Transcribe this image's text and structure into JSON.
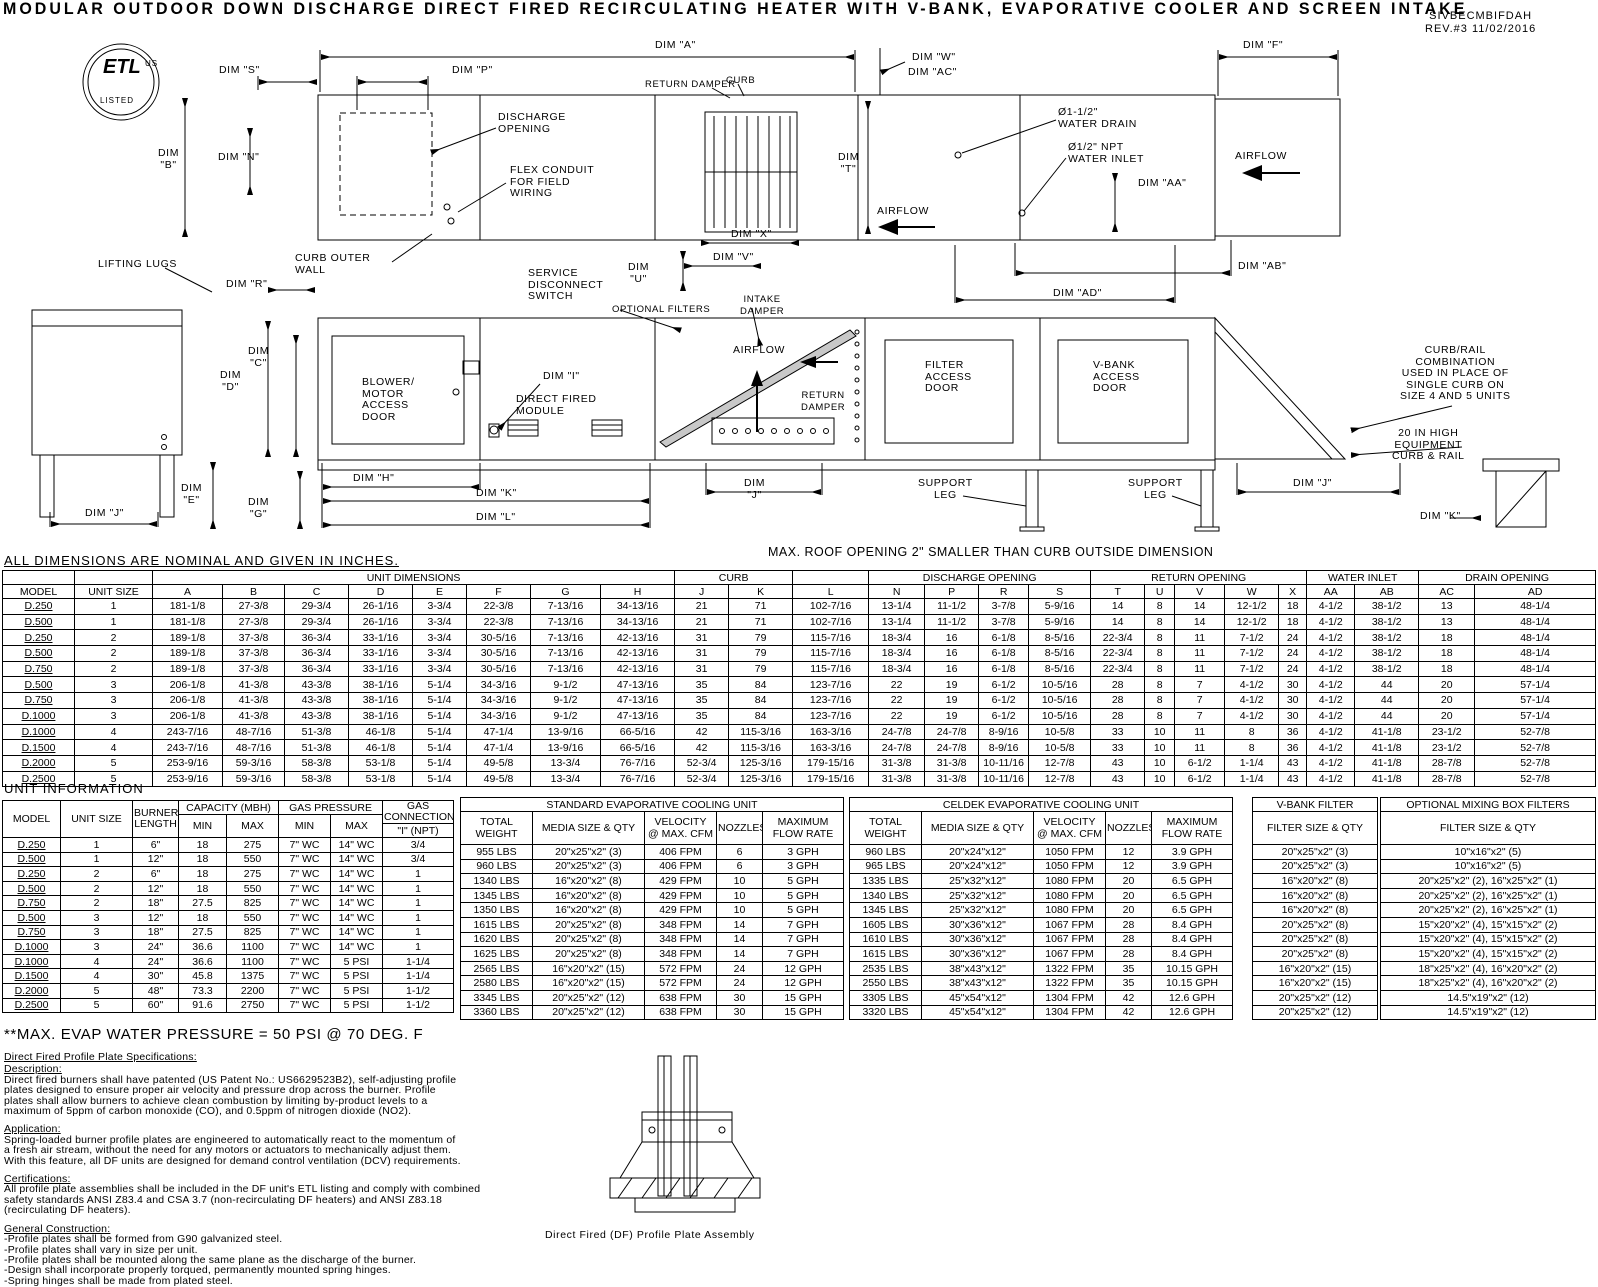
{
  "header": {
    "title": "MODULAR OUTDOOR DOWN DISCHARGE DIRECT FIRED RECIRCULATING HEATER WITH V-BANK, EVAPORATIVE COOLER AND SCREEN INTAKE",
    "doc_code": "SIVBECMBIFDAH\nREV.#3  11/02/2016"
  },
  "notes": {
    "dims_note": "ALL DIMENSIONS ARE NOMINAL AND GIVEN IN INCHES.",
    "roof_note": "MAX. ROOF OPENING 2\" SMALLER THAN CURB OUTSIDE DIMENSION",
    "evap_note": "**MAX. EVAP WATER PRESSURE = 50 PSI @ 70 DEG. F",
    "assembly_caption": "Direct Fired (DF) Profile Plate Assembly"
  },
  "drawing": {
    "labels": {
      "etl_mark": "ETL",
      "etl_listed": "LISTED",
      "etl_us": "US",
      "dim_s": "DIM \"S\"",
      "dim_p": "DIM \"P\"",
      "dim_a": "DIM \"A\"",
      "dim_f": "DIM \"F\"",
      "dim_w": "DIM \"W\"",
      "dim_ac": "DIM \"AC\"",
      "return_damper": "RETURN DAMPER",
      "curb": "CURB",
      "discharge_opening": "DISCHARGE\nOPENING",
      "water_drain": "Ø1-1/2\"\nWATER DRAIN",
      "water_inlet": "Ø1/2\" NPT\nWATER INLET",
      "airflow_top_right": "AIRFLOW",
      "dim_b": "DIM\n\"B\"",
      "dim_n": "DIM \"N\"",
      "dim_t": "DIM\n\"T\"",
      "flex_conduit": "FLEX CONDUIT\nFOR FIELD\nWIRING",
      "dim_aa": "DIM \"AA\"",
      "airflow_mid": "AIRFLOW",
      "dim_x": "DIM \"X\"",
      "dim_v": "DIM \"V\"",
      "dim_ab": "DIM \"AB\"",
      "lifting_lugs": "LIFTING LUGS",
      "curb_outer_wall": "CURB OUTER\nWALL",
      "service_disconnect": "SERVICE\nDISCONNECT\nSWITCH",
      "dim_u": "DIM\n\"U\"",
      "dim_r": "DIM \"R\"",
      "dim_ad": "DIM \"AD\"",
      "intake_damper": "INTAKE\nDAMPER",
      "optional_filters": "OPTIONAL FILTERS",
      "dim_c": "DIM\n\"C\"",
      "dim_d": "DIM\n\"D\"",
      "airflow_center": "AIRFLOW",
      "blower_door": "BLOWER/\nMOTOR\nACCESS\nDOOR",
      "dim_i": "DIM \"I\"",
      "direct_fired_module": "DIRECT FIRED\nMODULE",
      "return_damper_2": "RETURN\nDAMPER",
      "filter_access_door": "FILTER\nACCESS\nDOOR",
      "vbank_access_door": "V-BANK\nACCESS\nDOOR",
      "curb_rail_combo": "CURB/RAIL\nCOMBINATION\nUSED IN PLACE OF\nSINGLE CURB ON\nSIZE 4 AND 5 UNITS",
      "curb_20": "20 IN HIGH\nEQUIPMENT\nCURB & RAIL",
      "support_leg_1": "SUPPORT\nLEG",
      "support_leg_2": "SUPPORT\nLEG",
      "dim_e": "DIM\n\"E\"",
      "dim_g": "DIM\n\"G\"",
      "dim_h": "DIM \"H\"",
      "dim_k_bottom": "DIM \"K\"",
      "dim_l": "DIM \"L\"",
      "dim_j_mid": "DIM\n\"J\"",
      "dim_j_left": "DIM \"J\"",
      "dim_j_right": "DIM \"J\"",
      "dim_k_right": "DIM \"K\""
    }
  },
  "dimension_table": {
    "group_headers": {
      "unit_dimensions": "UNIT DIMENSIONS",
      "curb": "CURB",
      "discharge": "DISCHARGE OPENING",
      "return": "RETURN OPENING",
      "water_inlet": "WATER INLET",
      "drain": "DRAIN OPENING"
    },
    "columns": [
      "MODEL",
      "UNIT SIZE",
      "A",
      "B",
      "C",
      "D",
      "E",
      "F",
      "G",
      "H",
      "J",
      "K",
      "L",
      "N",
      "P",
      "R",
      "S",
      "T",
      "U",
      "V",
      "W",
      "X",
      "AA",
      "AB",
      "AC",
      "AD"
    ],
    "rows": [
      [
        "D.250",
        "1",
        "181-1/8",
        "27-3/8",
        "29-3/4",
        "26-1/16",
        "3-3/4",
        "22-3/8",
        "7-13/16",
        "34-13/16",
        "21",
        "71",
        "102-7/16",
        "13-1/4",
        "11-1/2",
        "3-7/8",
        "5-9/16",
        "14",
        "8",
        "14",
        "12-1/2",
        "18",
        "4-1/2",
        "38-1/2",
        "13",
        "48-1/4"
      ],
      [
        "D.500",
        "1",
        "181-1/8",
        "27-3/8",
        "29-3/4",
        "26-1/16",
        "3-3/4",
        "22-3/8",
        "7-13/16",
        "34-13/16",
        "21",
        "71",
        "102-7/16",
        "13-1/4",
        "11-1/2",
        "3-7/8",
        "5-9/16",
        "14",
        "8",
        "14",
        "12-1/2",
        "18",
        "4-1/2",
        "38-1/2",
        "13",
        "48-1/4"
      ],
      [
        "D.250",
        "2",
        "189-1/8",
        "37-3/8",
        "36-3/4",
        "33-1/16",
        "3-3/4",
        "30-5/16",
        "7-13/16",
        "42-13/16",
        "31",
        "79",
        "115-7/16",
        "18-3/4",
        "16",
        "6-1/8",
        "8-5/16",
        "22-3/4",
        "8",
        "11",
        "7-1/2",
        "24",
        "4-1/2",
        "38-1/2",
        "18",
        "48-1/4"
      ],
      [
        "D.500",
        "2",
        "189-1/8",
        "37-3/8",
        "36-3/4",
        "33-1/16",
        "3-3/4",
        "30-5/16",
        "7-13/16",
        "42-13/16",
        "31",
        "79",
        "115-7/16",
        "18-3/4",
        "16",
        "6-1/8",
        "8-5/16",
        "22-3/4",
        "8",
        "11",
        "7-1/2",
        "24",
        "4-1/2",
        "38-1/2",
        "18",
        "48-1/4"
      ],
      [
        "D.750",
        "2",
        "189-1/8",
        "37-3/8",
        "36-3/4",
        "33-1/16",
        "3-3/4",
        "30-5/16",
        "7-13/16",
        "42-13/16",
        "31",
        "79",
        "115-7/16",
        "18-3/4",
        "16",
        "6-1/8",
        "8-5/16",
        "22-3/4",
        "8",
        "11",
        "7-1/2",
        "24",
        "4-1/2",
        "38-1/2",
        "18",
        "48-1/4"
      ],
      [
        "D.500",
        "3",
        "206-1/8",
        "41-3/8",
        "43-3/8",
        "38-1/16",
        "5-1/4",
        "34-3/16",
        "9-1/2",
        "47-13/16",
        "35",
        "84",
        "123-7/16",
        "22",
        "19",
        "6-1/2",
        "10-5/16",
        "28",
        "8",
        "7",
        "4-1/2",
        "30",
        "4-1/2",
        "44",
        "20",
        "57-1/4"
      ],
      [
        "D.750",
        "3",
        "206-1/8",
        "41-3/8",
        "43-3/8",
        "38-1/16",
        "5-1/4",
        "34-3/16",
        "9-1/2",
        "47-13/16",
        "35",
        "84",
        "123-7/16",
        "22",
        "19",
        "6-1/2",
        "10-5/16",
        "28",
        "8",
        "7",
        "4-1/2",
        "30",
        "4-1/2",
        "44",
        "20",
        "57-1/4"
      ],
      [
        "D.1000",
        "3",
        "206-1/8",
        "41-3/8",
        "43-3/8",
        "38-1/16",
        "5-1/4",
        "34-3/16",
        "9-1/2",
        "47-13/16",
        "35",
        "84",
        "123-7/16",
        "22",
        "19",
        "6-1/2",
        "10-5/16",
        "28",
        "8",
        "7",
        "4-1/2",
        "30",
        "4-1/2",
        "44",
        "20",
        "57-1/4"
      ],
      [
        "D.1000",
        "4",
        "243-7/16",
        "48-7/16",
        "51-3/8",
        "46-1/8",
        "5-1/4",
        "47-1/4",
        "13-9/16",
        "66-5/16",
        "42",
        "115-3/16",
        "163-3/16",
        "24-7/8",
        "24-7/8",
        "8-9/16",
        "10-5/8",
        "33",
        "10",
        "11",
        "8",
        "36",
        "4-1/2",
        "41-1/8",
        "23-1/2",
        "52-7/8"
      ],
      [
        "D.1500",
        "4",
        "243-7/16",
        "48-7/16",
        "51-3/8",
        "46-1/8",
        "5-1/4",
        "47-1/4",
        "13-9/16",
        "66-5/16",
        "42",
        "115-3/16",
        "163-3/16",
        "24-7/8",
        "24-7/8",
        "8-9/16",
        "10-5/8",
        "33",
        "10",
        "11",
        "8",
        "36",
        "4-1/2",
        "41-1/8",
        "23-1/2",
        "52-7/8"
      ],
      [
        "D.2000",
        "5",
        "253-9/16",
        "59-3/16",
        "58-3/8",
        "53-1/8",
        "5-1/4",
        "49-5/8",
        "13-3/4",
        "76-7/16",
        "52-3/4",
        "125-3/16",
        "179-15/16",
        "31-3/8",
        "31-3/8",
        "10-11/16",
        "12-7/8",
        "43",
        "10",
        "6-1/2",
        "1-1/4",
        "43",
        "4-1/2",
        "41-1/8",
        "28-7/8",
        "52-7/8"
      ],
      [
        "D.2500",
        "5",
        "253-9/16",
        "59-3/16",
        "58-3/8",
        "53-1/8",
        "5-1/4",
        "49-5/8",
        "13-3/4",
        "76-7/16",
        "52-3/4",
        "125-3/16",
        "179-15/16",
        "31-3/8",
        "31-3/8",
        "10-11/16",
        "12-7/8",
        "43",
        "10",
        "6-1/2",
        "1-1/4",
        "43",
        "4-1/2",
        "41-1/8",
        "28-7/8",
        "52-7/8"
      ]
    ]
  },
  "unit_information": {
    "title": "UNIT INFORMATION",
    "headers": {
      "model": "MODEL",
      "unit_size": "UNIT SIZE",
      "burner_length": "BURNER\nLENGTH",
      "capacity": "CAPACITY (MBH)",
      "gas_pressure": "GAS PRESSURE",
      "gas_connection": "GAS\nCONNECTION",
      "npt": "\"I\" (NPT)",
      "min": "MIN",
      "max": "MAX"
    },
    "rows": [
      [
        "D.250",
        "1",
        "6\"",
        "18",
        "275",
        "7\" WC",
        "14\" WC",
        "3/4"
      ],
      [
        "D.500",
        "1",
        "12\"",
        "18",
        "550",
        "7\" WC",
        "14\" WC",
        "3/4"
      ],
      [
        "D.250",
        "2",
        "6\"",
        "18",
        "275",
        "7\" WC",
        "14\" WC",
        "1"
      ],
      [
        "D.500",
        "2",
        "12\"",
        "18",
        "550",
        "7\" WC",
        "14\" WC",
        "1"
      ],
      [
        "D.750",
        "2",
        "18\"",
        "27.5",
        "825",
        "7\" WC",
        "14\" WC",
        "1"
      ],
      [
        "D.500",
        "3",
        "12\"",
        "18",
        "550",
        "7\" WC",
        "14\" WC",
        "1"
      ],
      [
        "D.750",
        "3",
        "18\"",
        "27.5",
        "825",
        "7\" WC",
        "14\" WC",
        "1"
      ],
      [
        "D.1000",
        "3",
        "24\"",
        "36.6",
        "1100",
        "7\" WC",
        "14\" WC",
        "1"
      ],
      [
        "D.1000",
        "4",
        "24\"",
        "36.6",
        "1100",
        "7\" WC",
        "5 PSI",
        "1-1/4"
      ],
      [
        "D.1500",
        "4",
        "30\"",
        "45.8",
        "1375",
        "7\" WC",
        "5 PSI",
        "1-1/4"
      ],
      [
        "D.2000",
        "5",
        "48\"",
        "73.3",
        "2200",
        "7\" WC",
        "5 PSI",
        "1-1/2"
      ],
      [
        "D.2500",
        "5",
        "60\"",
        "91.6",
        "2750",
        "7\" WC",
        "5 PSI",
        "1-1/2"
      ]
    ]
  },
  "standard_evap": {
    "title": "STANDARD EVAPORATIVE COOLING UNIT",
    "headers": [
      "TOTAL\nWEIGHT",
      "MEDIA SIZE & QTY",
      "VELOCITY\n@ MAX. CFM",
      "NOZZLES",
      "MAXIMUM\nFLOW RATE"
    ],
    "rows": [
      [
        "955 LBS",
        "20\"x25\"x2\" (3)",
        "406 FPM",
        "6",
        "3 GPH"
      ],
      [
        "960 LBS",
        "20\"x25\"x2\" (3)",
        "406 FPM",
        "6",
        "3 GPH"
      ],
      [
        "1340 LBS",
        "16\"x20\"x2\" (8)",
        "429 FPM",
        "10",
        "5 GPH"
      ],
      [
        "1345 LBS",
        "16\"x20\"x2\" (8)",
        "429 FPM",
        "10",
        "5 GPH"
      ],
      [
        "1350 LBS",
        "16\"x20\"x2\" (8)",
        "429 FPM",
        "10",
        "5 GPH"
      ],
      [
        "1615 LBS",
        "20\"x25\"x2\" (8)",
        "348 FPM",
        "14",
        "7 GPH"
      ],
      [
        "1620 LBS",
        "20\"x25\"x2\" (8)",
        "348 FPM",
        "14",
        "7 GPH"
      ],
      [
        "1625 LBS",
        "20\"x25\"x2\" (8)",
        "348 FPM",
        "14",
        "7 GPH"
      ],
      [
        "2565 LBS",
        "16\"x20\"x2\" (15)",
        "572 FPM",
        "24",
        "12 GPH"
      ],
      [
        "2580 LBS",
        "16\"x20\"x2\" (15)",
        "572 FPM",
        "24",
        "12 GPH"
      ],
      [
        "3345 LBS",
        "20\"x25\"x2\" (12)",
        "638 FPM",
        "30",
        "15 GPH"
      ],
      [
        "3360 LBS",
        "20\"x25\"x2\" (12)",
        "638 FPM",
        "30",
        "15 GPH"
      ]
    ]
  },
  "celdek_evap": {
    "title": "CELDEK EVAPORATIVE COOLING UNIT",
    "headers": [
      "TOTAL\nWEIGHT",
      "MEDIA SIZE & QTY",
      "VELOCITY\n@ MAX. CFM",
      "NOZZLES",
      "MAXIMUM\nFLOW RATE"
    ],
    "rows": [
      [
        "960 LBS",
        "20\"x24\"x12\"",
        "1050 FPM",
        "12",
        "3.9 GPH"
      ],
      [
        "965 LBS",
        "20\"x24\"x12\"",
        "1050 FPM",
        "12",
        "3.9 GPH"
      ],
      [
        "1335 LBS",
        "25\"x32\"x12\"",
        "1080 FPM",
        "20",
        "6.5 GPH"
      ],
      [
        "1340 LBS",
        "25\"x32\"x12\"",
        "1080 FPM",
        "20",
        "6.5 GPH"
      ],
      [
        "1345 LBS",
        "25\"x32\"x12\"",
        "1080 FPM",
        "20",
        "6.5 GPH"
      ],
      [
        "1605 LBS",
        "30\"x36\"x12\"",
        "1067 FPM",
        "28",
        "8.4 GPH"
      ],
      [
        "1610 LBS",
        "30\"x36\"x12\"",
        "1067 FPM",
        "28",
        "8.4 GPH"
      ],
      [
        "1615 LBS",
        "30\"x36\"x12\"",
        "1067 FPM",
        "28",
        "8.4 GPH"
      ],
      [
        "2535 LBS",
        "38\"x43\"x12\"",
        "1322 FPM",
        "35",
        "10.15 GPH"
      ],
      [
        "2550 LBS",
        "38\"x43\"x12\"",
        "1322 FPM",
        "35",
        "10.15 GPH"
      ],
      [
        "3305 LBS",
        "45\"x54\"x12\"",
        "1304 FPM",
        "42",
        "12.6 GPH"
      ],
      [
        "3320 LBS",
        "45\"x54\"x12\"",
        "1304 FPM",
        "42",
        "12.6 GPH"
      ]
    ]
  },
  "vbank_filter": {
    "title": "V-BANK FILTER",
    "headers": [
      "FILTER SIZE & QTY"
    ],
    "rows": [
      [
        "20\"x25\"x2\" (3)"
      ],
      [
        "20\"x25\"x2\" (3)"
      ],
      [
        "16\"x20\"x2\" (8)"
      ],
      [
        "16\"x20\"x2\" (8)"
      ],
      [
        "16\"x20\"x2\" (8)"
      ],
      [
        "20\"x25\"x2\" (8)"
      ],
      [
        "20\"x25\"x2\" (8)"
      ],
      [
        "20\"x25\"x2\" (8)"
      ],
      [
        "16\"x20\"x2\" (15)"
      ],
      [
        "16\"x20\"x2\" (15)"
      ],
      [
        "20\"x25\"x2\" (12)"
      ],
      [
        "20\"x25\"x2\" (12)"
      ]
    ]
  },
  "mixing_box": {
    "title": "OPTIONAL MIXING BOX FILTERS",
    "headers": [
      "FILTER SIZE & QTY"
    ],
    "rows": [
      [
        "10\"x16\"x2\" (5)"
      ],
      [
        "10\"x16\"x2\" (5)"
      ],
      [
        "20\"x25\"x2\" (2), 16\"x25\"x2\" (1)"
      ],
      [
        "20\"x25\"x2\" (2), 16\"x25\"x2\" (1)"
      ],
      [
        "20\"x25\"x2\" (2), 16\"x25\"x2\" (1)"
      ],
      [
        "15\"x20\"x2\" (4), 15\"x15\"x2\" (2)"
      ],
      [
        "15\"x20\"x2\" (4), 15\"x15\"x2\" (2)"
      ],
      [
        "15\"x20\"x2\" (4), 15\"x15\"x2\" (2)"
      ],
      [
        "18\"x25\"x2\" (4), 16\"x20\"x2\" (2)"
      ],
      [
        "18\"x25\"x2\" (4), 16\"x20\"x2\" (2)"
      ],
      [
        "14.5\"x19\"x2\" (12)"
      ],
      [
        "14.5\"x19\"x2\" (12)"
      ]
    ]
  },
  "specs": {
    "sections": [
      {
        "heading": "Direct Fired Profile Plate Specifications:",
        "body": ""
      },
      {
        "heading": "Description:",
        "body": "Direct fired burners shall have patented (US Patent No.: US6629523B2), self-adjusting profile\nplates designed to ensure proper air velocity and pressure drop across the burner. Profile\nplates shall allow burners to achieve clean combustion by limiting by-product levels to a\nmaximum of 5ppm of carbon monoxide (CO), and 0.5ppm of nitrogen dioxide (NO2)."
      },
      {
        "heading": "Application:",
        "body": "Spring-loaded burner profile plates are engineered to automatically react to the momentum of\na fresh air stream, without the need for any motors or actuators to mechanically adjust them.\nWith this feature, all DF units are designed for demand control ventilation (DCV) requirements."
      },
      {
        "heading": "Certifications:",
        "body": "All profile plate assemblies shall be included in the DF unit's ETL listing and comply with combined\nsafety standards ANSI Z83.4 and CSA 3.7 (non-recirculating DF heaters) and ANSI Z83.18\n(recirculating DF heaters)."
      },
      {
        "heading": "General Construction:",
        "body": "-Profile plates shall be formed from G90 galvanized steel.\n-Profile plates shall vary in size per unit.\n-Profile plates shall be mounted along the same plane as the discharge of the burner.\n-Design shall incorporate properly torqued, permanently mounted spring hinges.\n-Spring hinges shall be made from plated steel."
      }
    ]
  }
}
